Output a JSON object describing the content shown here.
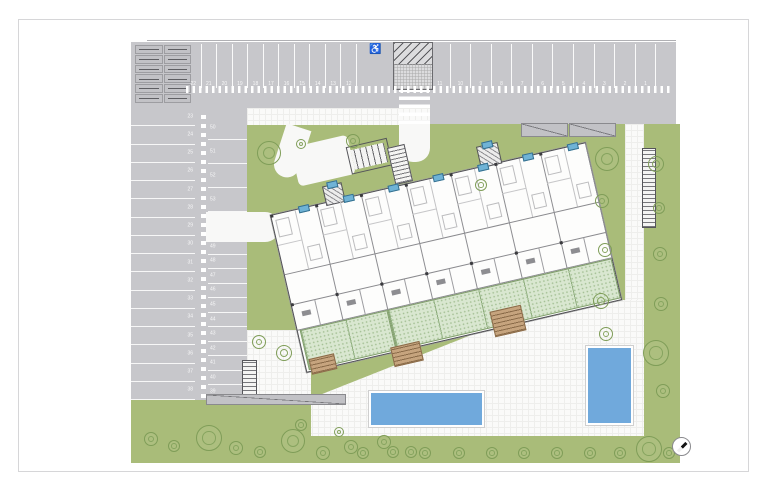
{
  "sheet": {
    "accessible_symbol": "♿"
  },
  "parking": {
    "top_left_numbers": [
      "22",
      "21",
      "20",
      "19",
      "18",
      "17",
      "16",
      "15",
      "14",
      "13",
      "12"
    ],
    "top_right_numbers": [
      "11",
      "10",
      "9",
      "8",
      "7",
      "6",
      "5",
      "4",
      "3",
      "2",
      "1",
      ""
    ],
    "west_column_numbers": [
      "23",
      "24",
      "25",
      "26",
      "27",
      "28",
      "29",
      "30",
      "31",
      "32",
      "33",
      "34",
      "35",
      "36",
      "37",
      "38"
    ],
    "middle_column_upper_numbers": [
      "50",
      "51",
      "52",
      "53"
    ],
    "middle_column_lower_numbers": [
      "49",
      "48",
      "47",
      "46",
      "45",
      "44",
      "43",
      "42",
      "41",
      "40",
      "39"
    ],
    "storage_cell_count": 12
  },
  "site": {
    "building_units": 7,
    "stair_cores": 2,
    "pool_count": 2,
    "wooden_decks": 3
  },
  "colors": {
    "asphalt": "#c7c7cb",
    "lawn": "#a9bc79",
    "pool": "#70a9dc",
    "terrace_mint": "#d9e7d0",
    "wood": "#c6a47e",
    "marker_blue": "#6fb3d6"
  },
  "compass": {
    "direction": "NE",
    "needle_angle_deg": 45
  }
}
